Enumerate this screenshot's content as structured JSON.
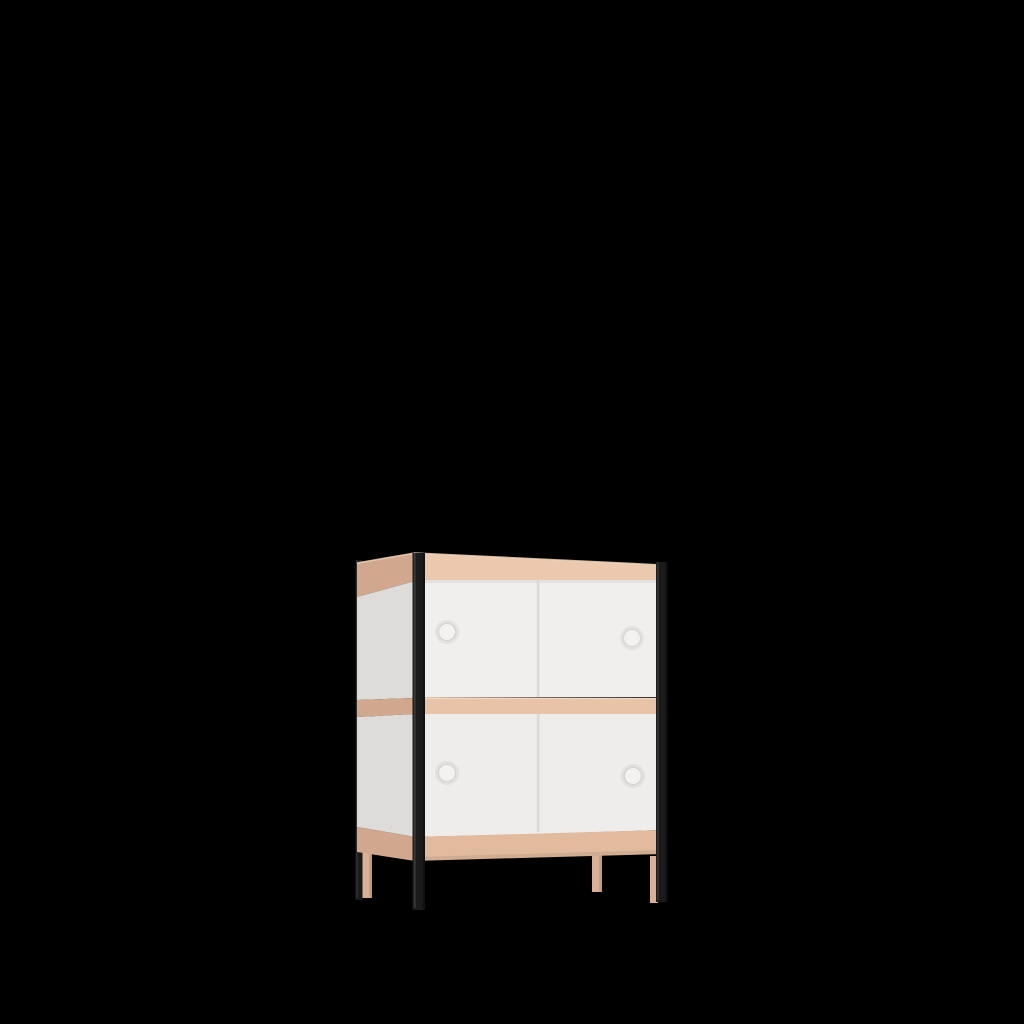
{
  "scene": {
    "description": "3D product render of a two-tier storage cabinet with four white sliding doors, round finger-hole handles, pale beech wood rails and legs, and slim black metal corner posts, centered on a solid black background.",
    "background": "#000000"
  },
  "cabinet": {
    "tiers": 2,
    "door_count": 4,
    "handle_count": 4,
    "metal_post_count": 3,
    "wood_leg_count": 3
  },
  "colors": {
    "background": "#000000",
    "metal_post": "#1b1b1b",
    "wood_top_rail": "#ecc9ae",
    "wood_middle_rail": "#e8c3a7",
    "wood_bottom_rail": "#e2bb9e",
    "wood_side_rail": "#ddb295",
    "wood_leg": "#d9b093",
    "door_white": "#f0efed",
    "door_white_lower": "#efedeb",
    "side_panel_white": "#eae8e6",
    "seam_gray": "#dcdad7",
    "handle_fill": "#f3f2f0",
    "handle_ring": "#d7d4d1",
    "edge_highlight": "#f0d4ba"
  }
}
